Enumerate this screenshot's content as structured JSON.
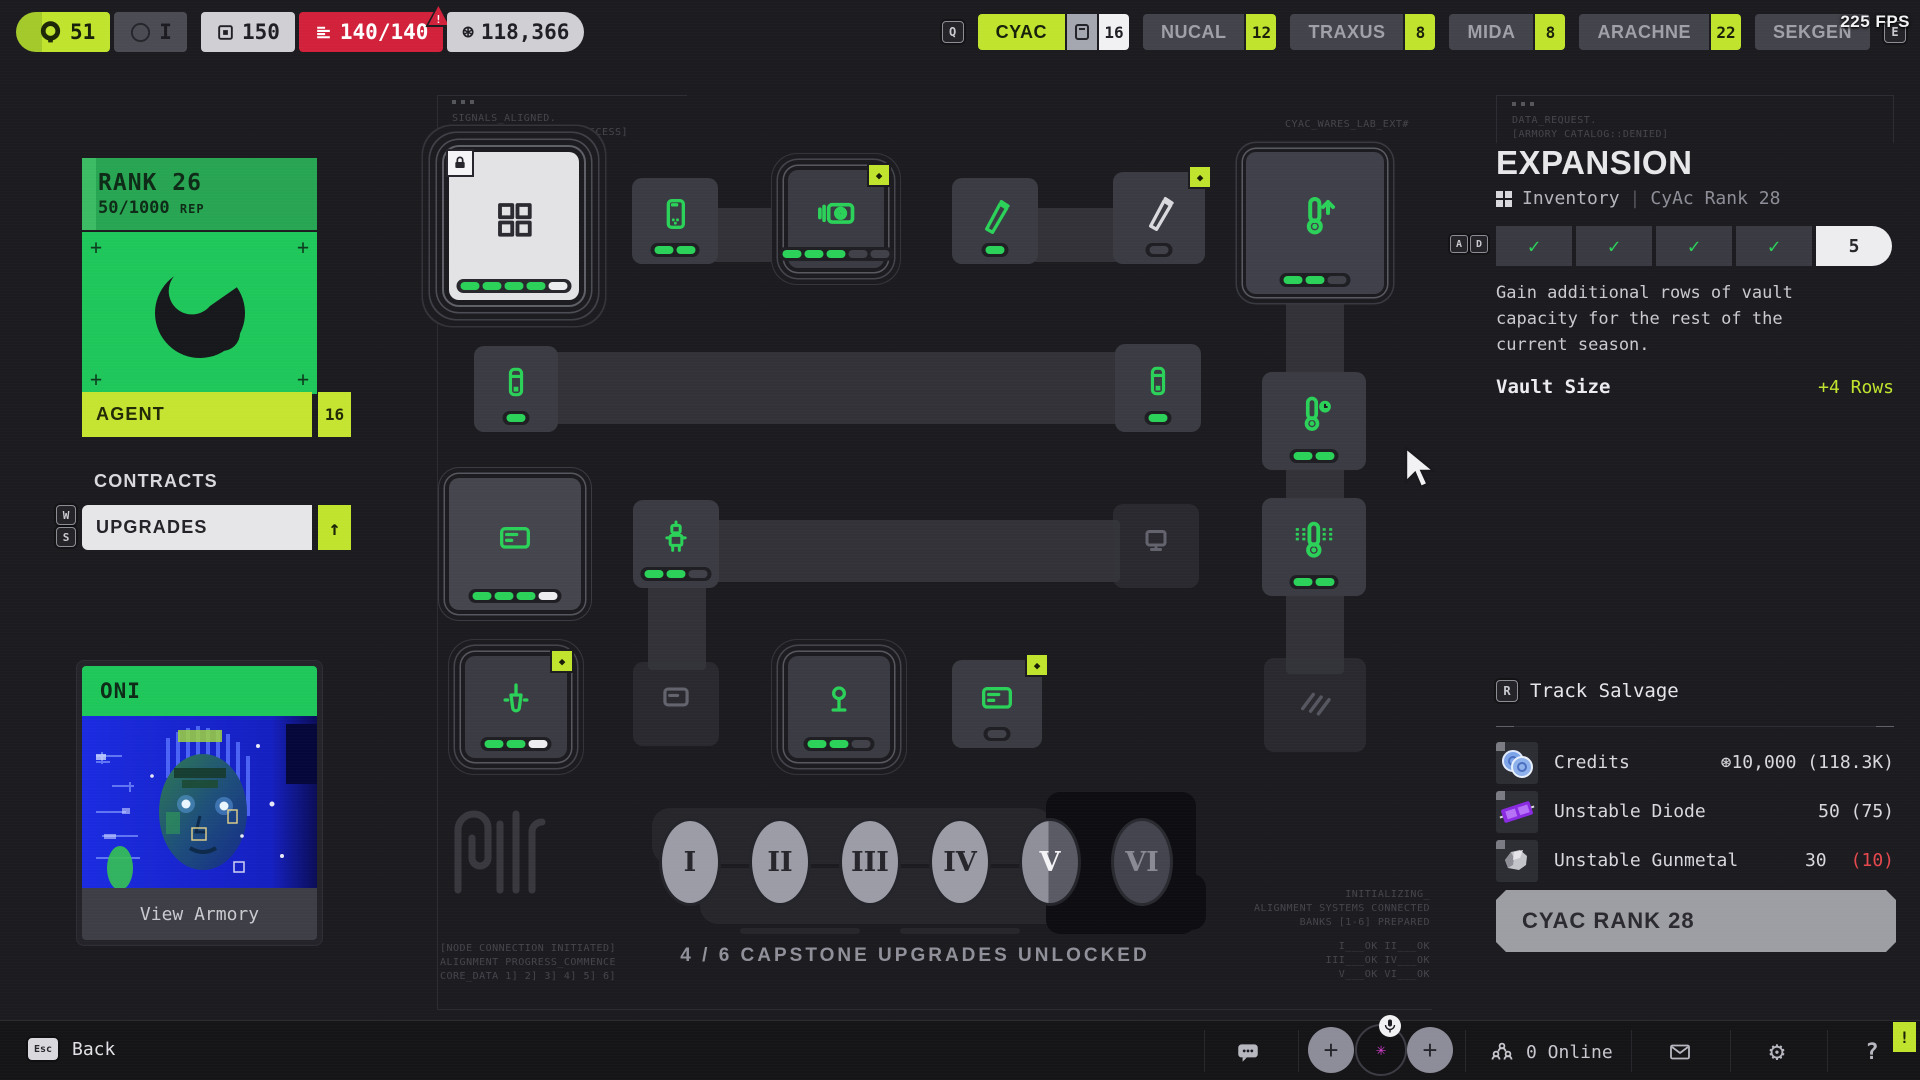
{
  "icons": {
    "credits": "⊛",
    "gear": "⚙",
    "arrow-up": "↑",
    "diamond": "◆",
    "check": "✓",
    "avatar-star": "✳",
    "question": "?",
    "alert": "!",
    "plus": "+",
    "warning": "!"
  },
  "colors": {
    "lime": "#c0e42e",
    "green": "#2bd158",
    "red": "#d2213b",
    "rank_green": "#1fc75b",
    "background": "#1c1c20"
  },
  "hud": {
    "badges": [
      {
        "label": "51",
        "icon": "cyac-ring"
      },
      {
        "label": "I",
        "icon": "circle-outline"
      },
      {
        "label": "150",
        "icon": "frame"
      },
      {
        "label": "140/140",
        "icon": "stack",
        "alert": true
      },
      {
        "label": "118,366",
        "icon": "credits"
      }
    ],
    "fps": "225 FPS",
    "faction_tabs": [
      {
        "label": "CYAC",
        "count": "16",
        "active": true
      },
      {
        "label": "NUCAL",
        "count": "12",
        "active": false
      },
      {
        "label": "TRAXUS",
        "count": "8",
        "active": false
      },
      {
        "label": "MIDA",
        "count": "8",
        "active": false
      },
      {
        "label": "ARACHNE",
        "count": "22",
        "active": false
      },
      {
        "label": "SEKGEN",
        "count": "",
        "active": false
      }
    ],
    "keys": {
      "prev": "Q",
      "next": "E",
      "up": "W",
      "down": "S",
      "left": "A",
      "right": "D",
      "track": "R",
      "back": "Esc"
    }
  },
  "sidebar": {
    "rank": {
      "title": "RANK 26",
      "rep": "50/1000",
      "rep_suffix": "REP"
    },
    "agent": {
      "label": "AGENT",
      "count": "16"
    },
    "contracts_label": "CONTRACTS",
    "upgrades_label": "UPGRADES",
    "armory": {
      "faction": "ONI",
      "action": "View Armory"
    }
  },
  "tree": {
    "annotations": {
      "top_left": [
        "SIGNALS_ALIGNED.",
        "[RUNNER RESONANCE::SUCCESS]"
      ],
      "top_right": "CYAC_WARES_LAB_EXT#",
      "bottom_left": [
        "[NODE CONNECTION INITIATED]",
        "ALIGNMENT PROGRESS_COMMENCE",
        "CORE_DATA 1] 2] 3] 4] 5] 6]"
      ],
      "bottom_right": [
        "INITIALIZING_",
        "ALIGNMENT SYSTEMS CONNECTED",
        "BANKS [1-6] PREPARED"
      ],
      "bottom_right_status": [
        "I___OK   II___OK",
        "III___OK  IV___OK",
        "V___OK   VI___OK"
      ]
    },
    "capstone_status": "4 / 6 CAPSTONE UPGRADES UNLOCKED",
    "capstones": [
      {
        "numeral": "I",
        "state": "done"
      },
      {
        "numeral": "II",
        "state": "done"
      },
      {
        "numeral": "III",
        "state": "done"
      },
      {
        "numeral": "IV",
        "state": "done"
      },
      {
        "numeral": "V",
        "state": "current"
      },
      {
        "numeral": "VI",
        "state": "locked"
      }
    ],
    "nodes": [
      {
        "name": "vault-grid-upgrade",
        "icon": "grid",
        "progress": "ggggw",
        "style": "selected",
        "lock": true,
        "badge": false
      },
      {
        "name": "device-upgrade",
        "icon": "phone",
        "progress": "gg",
        "style": "node",
        "lock": false,
        "badge": false
      },
      {
        "name": "optics-upgrade",
        "icon": "camera",
        "progress": "gggdd",
        "style": "ring",
        "lock": false,
        "badge": true
      },
      {
        "name": "injector-upgrade",
        "icon": "pen",
        "progress": "g",
        "style": "node",
        "lock": false,
        "badge": false
      },
      {
        "name": "injector-upgrade-2",
        "icon": "pen-light",
        "progress": "d",
        "style": "node",
        "lock": false,
        "badge": true
      },
      {
        "name": "thermal-boost-upgrade",
        "icon": "thermo-up",
        "progress": "ggd",
        "style": "big",
        "lock": false,
        "badge": false
      },
      {
        "name": "vial-upgrade",
        "icon": "tube",
        "progress": "g",
        "style": "node",
        "lock": false,
        "badge": false
      },
      {
        "name": "vial-upgrade-2",
        "icon": "tube",
        "progress": "g",
        "style": "node",
        "lock": false,
        "badge": false
      },
      {
        "name": "thermal-timer-upgrade",
        "icon": "thermo-clock",
        "progress": "gg",
        "style": "node",
        "lock": false,
        "badge": false
      },
      {
        "name": "vault-card-upgrade",
        "icon": "card",
        "progress": "gggw",
        "style": "ring2",
        "lock": false,
        "badge": false
      },
      {
        "name": "drone-upgrade",
        "icon": "robot",
        "progress": "ggd",
        "style": "node",
        "lock": false,
        "badge": false
      },
      {
        "name": "monitor-upgrade",
        "icon": "monitor",
        "progress": "",
        "style": "locked",
        "lock": false,
        "badge": false
      },
      {
        "name": "thermal-vent-upgrade",
        "icon": "thermo-waves",
        "progress": "gg",
        "style": "node",
        "lock": false,
        "badge": false
      },
      {
        "name": "dropper-upgrade",
        "icon": "dropper",
        "progress": "ggw",
        "style": "ring",
        "lock": false,
        "badge": true
      },
      {
        "name": "relay-upgrade",
        "icon": "card2",
        "progress": "",
        "style": "locked",
        "lock": false,
        "badge": false
      },
      {
        "name": "beacon-upgrade",
        "icon": "lamp",
        "progress": "ggd",
        "style": "ring",
        "lock": false,
        "badge": false
      },
      {
        "name": "console-upgrade",
        "icon": "card",
        "progress": "d",
        "style": "node",
        "lock": false,
        "badge": true
      },
      {
        "name": "locked-upgrade",
        "icon": "diagonal",
        "progress": "",
        "style": "locked",
        "lock": false,
        "badge": false
      }
    ]
  },
  "panel": {
    "annotation": [
      "DATA_REQUEST.",
      "[ARMORY CATALOG::DENIED]"
    ],
    "title": "EXPANSION",
    "breadcrumb": {
      "primary": "Inventory",
      "secondary": "CyAc Rank 28"
    },
    "tier_progress": {
      "completed": 4,
      "total": 5,
      "current_label": "5"
    },
    "description": "Gain additional rows of vault capacity for the rest of the current season.",
    "stat_label": "Vault Size",
    "stat_value": "+4 Rows",
    "track_salvage": "Track Salvage",
    "salvage": [
      {
        "name": "Credits",
        "value": "⊛10,000 (118.3K)",
        "alert": "",
        "icon": "coins"
      },
      {
        "name": "Unstable Diode",
        "value": "50 (75)",
        "alert": "",
        "icon": "diode"
      },
      {
        "name": "Unstable Gunmetal",
        "value": "30",
        "alert": "(10)",
        "icon": "gunmetal"
      }
    ],
    "rank_button": "CYAC RANK 28"
  },
  "footer": {
    "back": "Back",
    "online": "0 Online"
  }
}
